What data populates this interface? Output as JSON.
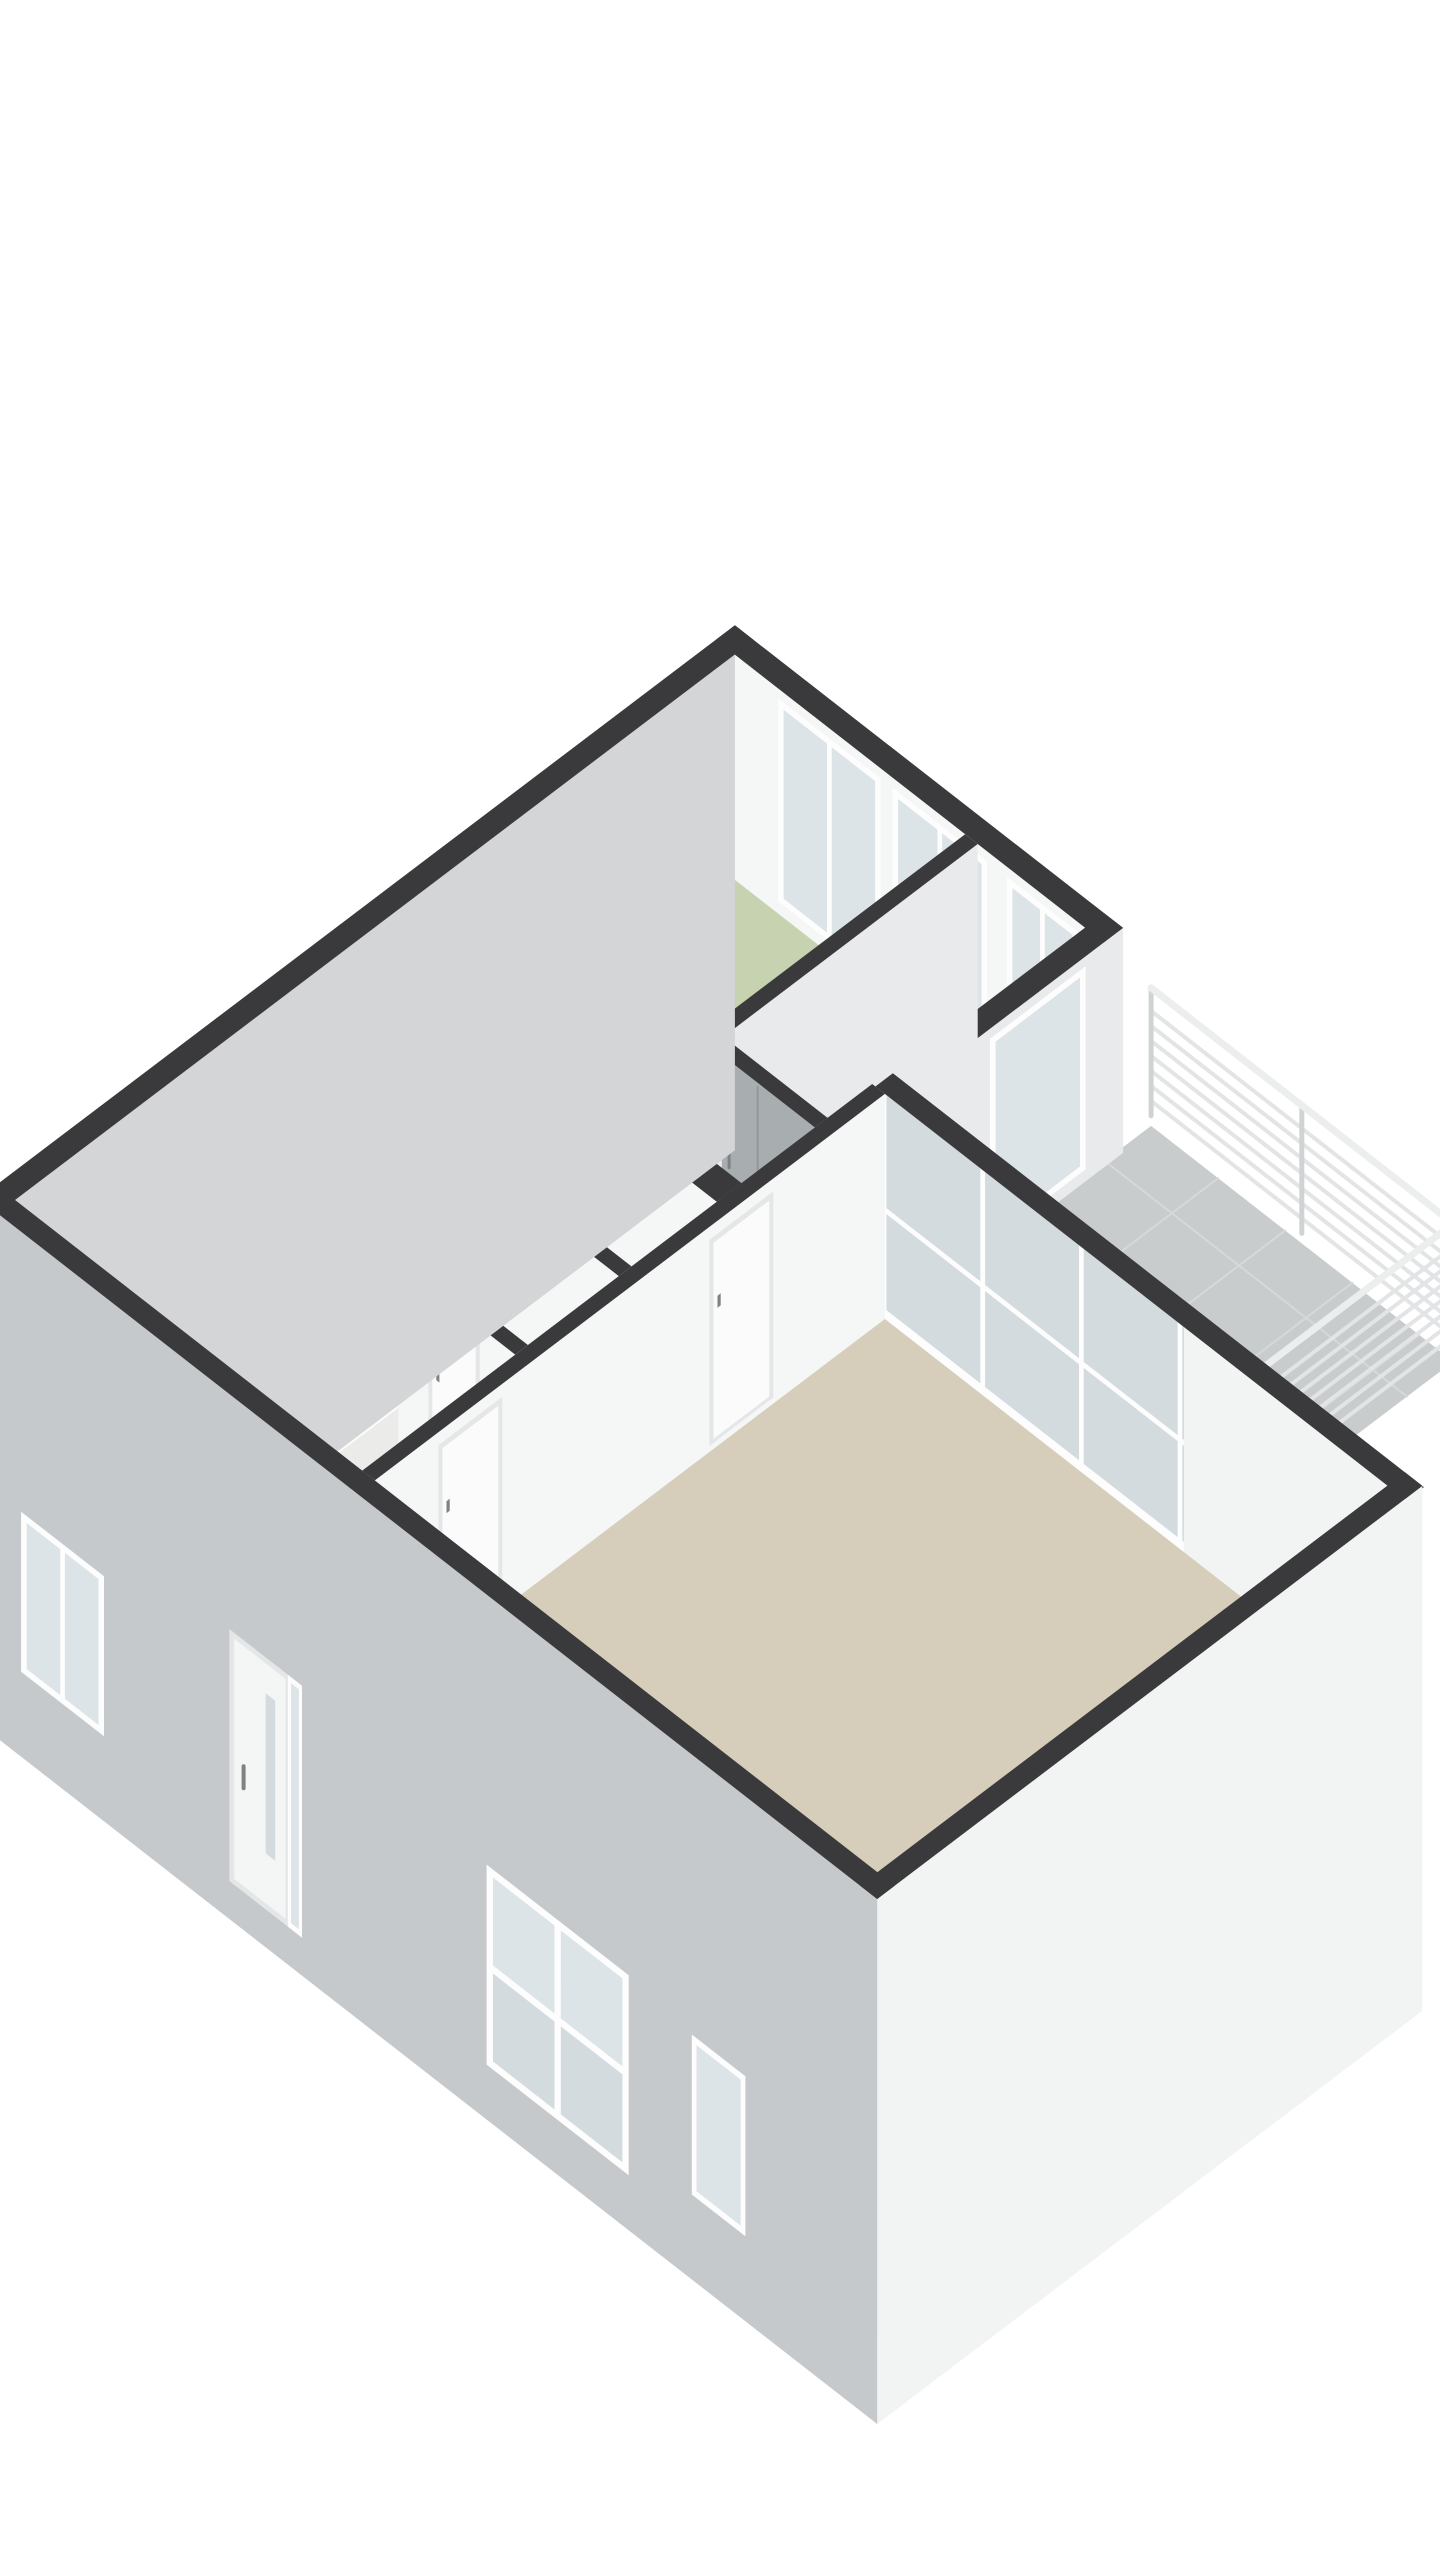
{
  "view": {
    "type": "3d-floorplan-dollhouse",
    "canvas": {
      "width": 1440,
      "height": 2560,
      "background": "#ffffff"
    }
  },
  "palette": {
    "band": "#3a3a3c",
    "wallWhite": "#f5f6f6",
    "wallLt": "#e9eaeb",
    "wallShade": "#dfe1e2",
    "wallIntNW": "#f1f2f2",
    "wardrobe": "#a8adaf",
    "wardrobeLine": "#94989a",
    "handle": "#7e8284",
    "green": "#c7d3b0",
    "blue": "#8ea6c2",
    "beige": "#d6cebb",
    "hallBeige": "#e7e2d6",
    "hallGrey": "#ebebe9",
    "whiteFloor": "#fafaf8",
    "balconyTile": "#c8cccc",
    "grout": "#d6d9d9",
    "extGreyNW": "#d3d5d6",
    "extGreySW": "#c6c9cb",
    "extWhite": "#f2f3f3",
    "glass": "#dde4e7",
    "glassDark": "#d3dbde",
    "frame": "#fdfdfd",
    "frameShade": "#e4e6e7",
    "sill": "#2d2d2f",
    "railSlat": "#e2e4e5",
    "railPost": "#cfd3d4",
    "railCap": "#eceeee",
    "fixture": "#c2c6c8",
    "counterTop": "#fbfbfa",
    "counterFront": "#ffffff",
    "counterSide": "#ebebea",
    "burner": "#1f1f1f",
    "columnTop": "#f0ede5",
    "columnFront": "#f7f5ef",
    "columnSide": "#e6e3da",
    "stubTop": "#e9eaea",
    "stubFace": "#f2f3f3"
  },
  "projection": {
    "o": [
      15,
      1425
    ],
    "u": [
      0.797,
      -0.604
    ],
    "v": [
      0.789,
      0.615
    ],
    "wallH": 225,
    "extDrop": -300
  },
  "floors": [
    {
      "name": "floor-living-room",
      "color": "beige",
      "rect": [
        456,
        4,
        1079,
        640
      ]
    },
    {
      "name": "floor-entry-hall",
      "color": "hallBeige",
      "rect": [
        246,
        4,
        436,
        445
      ]
    },
    {
      "name": "floor-hallway",
      "color": "hallGrey",
      "rect": [
        0,
        445,
        436,
        568
      ]
    },
    {
      "name": "floor-bathroom",
      "color": "blue",
      "rect": [
        0,
        208,
        282,
        445
      ]
    },
    {
      "name": "floor-toilet",
      "color": "whiteFloor",
      "rect": [
        298,
        208,
        436,
        322
      ]
    },
    {
      "name": "floor-study",
      "color": "green",
      "rect": [
        0,
        4,
        222,
        192
      ]
    },
    {
      "name": "floor-bedroom-1",
      "color": "green",
      "rect": [
        0,
        584,
        284,
        903
      ]
    },
    {
      "name": "floor-bedroom-2",
      "color": "green",
      "rect": [
        314,
        476,
        436,
        903
      ]
    }
  ],
  "balcony": {
    "name": "balcony",
    "floor": {
      "rect": [
        455,
        662,
        838,
        975
      ],
      "z": -10,
      "color": "balconyTile"
    },
    "tileStep": 85,
    "railing": {
      "pOut": 838,
      "qOut": 975,
      "qIn": 662,
      "pIn": 455,
      "slatZ0": 15,
      "slatStep": 15,
      "slats": 7,
      "capZ": 128,
      "postZ": 125,
      "posts": [
        455,
        646,
        838
      ]
    }
  },
  "walls": [
    {
      "name": "int-face-nw",
      "kind": "faceP",
      "p": 0,
      "q1": -22,
      "q2": 903,
      "color": "wallIntNW"
    },
    {
      "name": "ext-wall-ne",
      "kind": "q",
      "q": 903,
      "p1": -24,
      "p2": 468,
      "th": 24,
      "face": {
        "color": "wallWhite",
        "windows": [
          {
            "a": 55,
            "b": 185,
            "mullion": true
          },
          {
            "a": 200,
            "b": 320,
            "mullion": true
          },
          {
            "a": 345,
            "b": 435,
            "mullion": true
          }
        ]
      }
    },
    {
      "name": "ext-wall-bedroom2-balcony",
      "kind": "p",
      "p": 444,
      "q1": 640,
      "q2": 927,
      "th": 24,
      "eface": {
        "color": "wallLt",
        "windows": [
          {
            "a": 760,
            "b": 880,
            "mullion": false
          }
        ]
      }
    },
    {
      "name": "balcony-railing",
      "kind": "railing"
    },
    {
      "name": "wall-bedroom-divider",
      "kind": "p",
      "p": 292,
      "q1": 584,
      "q2": 903,
      "th": 16,
      "eface": {
        "color": "wallLt"
      }
    },
    {
      "name": "wall-corridor-north",
      "kind": "q",
      "q": 568,
      "p1": 0,
      "p2": 440,
      "th": 16,
      "face": {
        "color": "wallWhite",
        "wardrobe": {
          "a": 150,
          "b": 440
        }
      }
    },
    {
      "name": "wall-p306",
      "kind": "p",
      "p": 306,
      "q1": 476,
      "q2": 568,
      "th": 16,
      "eface": {
        "color": "wallLt"
      }
    },
    {
      "name": "wall-bedroom2-south",
      "kind": "q",
      "q": 460,
      "p1": 306,
      "p2": 440,
      "th": 16,
      "face": {
        "color": "wallWhite",
        "wardrobe": {
          "a": 306,
          "b": 440
        }
      }
    },
    {
      "name": "wall-hall-south-a",
      "kind": "q",
      "q": 445,
      "p1": 0,
      "p2": 246,
      "th": 16,
      "face": {
        "color": "wallWhite"
      }
    },
    {
      "name": "wall-hall-south-b",
      "kind": "q",
      "q": 445,
      "p1": 298,
      "p2": 440,
      "th": 16,
      "face": {
        "color": "wallWhite"
      }
    },
    {
      "name": "shower-partition",
      "kind": "stub",
      "q": 320,
      "p1": 0,
      "p2": 96,
      "th": 14,
      "h": 170
    },
    {
      "name": "shower-fixture",
      "kind": "shower",
      "p": 66,
      "q": 402
    },
    {
      "name": "wall-bathroom-east",
      "kind": "p",
      "p": 282,
      "q1": 200,
      "q2": 445,
      "th": 16,
      "eface": {
        "color": "wallShade",
        "doors": [
          {
            "a": 255,
            "b": 335
          }
        ]
      }
    },
    {
      "name": "wall-toilet-north",
      "kind": "q",
      "q": 322,
      "p1": 290,
      "p2": 440,
      "th": 16,
      "face": {
        "color": "wallWhite"
      }
    },
    {
      "name": "wall-q192",
      "kind": "q",
      "q": 192,
      "p1": 0,
      "p2": 440,
      "th": 16,
      "face": {
        "color": "wallWhite",
        "doors": [
          {
            "a": 180,
            "b": 245
          },
          {
            "a": 330,
            "b": 395
          }
        ]
      },
      "sill": {
        "a": 330,
        "b": 395
      }
    },
    {
      "name": "wall-study-east",
      "kind": "p",
      "p": 230,
      "q1": 4,
      "q2": 192,
      "th": 16,
      "eface": {
        "color": "wallLt"
      }
    },
    {
      "name": "wall-living-ne-glass",
      "kind": "glass",
      "q": 640,
      "p1": 444,
      "p2": 1117,
      "th": 22,
      "glassFrom": 455,
      "glassTo": 835,
      "panels": [
        455,
        580,
        705,
        830
      ]
    },
    {
      "name": "kitchen-counter",
      "kind": "counter",
      "rect": [
        250,
        100,
        298,
        186
      ],
      "h": 88,
      "burners": [
        [
          264,
          126
        ],
        [
          284,
          152
        ]
      ]
    },
    {
      "name": "wall-living-west",
      "kind": "p",
      "p": 440,
      "q1": 0,
      "q2": 640,
      "th": 16,
      "eface": {
        "color": "wallWhite",
        "doors": [
          {
            "a": 80,
            "b": 160
          },
          {
            "a": 420,
            "b": 500
          }
        ]
      }
    },
    {
      "name": "living-column",
      "kind": "column",
      "rect": [
        1020,
        260,
        1075,
        320
      ],
      "h": 110
    },
    {
      "name": "ext-wall-se",
      "kind": "extSE",
      "p": 1093,
      "q1": -24,
      "q2": 662,
      "th": 22
    },
    {
      "name": "ext-wall-nw",
      "kind": "extNW",
      "p": -24,
      "q1": -22,
      "q2": 927,
      "th": 24
    },
    {
      "name": "ext-wall-sw",
      "kind": "extSW",
      "q": -22,
      "p1": -24,
      "p2": 1115,
      "th": 22,
      "openings": {
        "studyWindow": {
          "a": 30,
          "b": 135,
          "zt": -55,
          "zb": -215,
          "mullion": true
        },
        "frontDoor": {
          "a": 300,
          "b": 365,
          "zt": -10,
          "zb": -262
        },
        "sidelight": {
          "a": 368,
          "b": 386,
          "zt": -10,
          "zb": -262
        },
        "bigWindow": {
          "a": 620,
          "b": 800,
          "zt": -45,
          "zb": -245
        },
        "smallWindow": {
          "a": 880,
          "b": 948,
          "zt": -55,
          "zb": -215,
          "mullion": false
        }
      }
    }
  ]
}
